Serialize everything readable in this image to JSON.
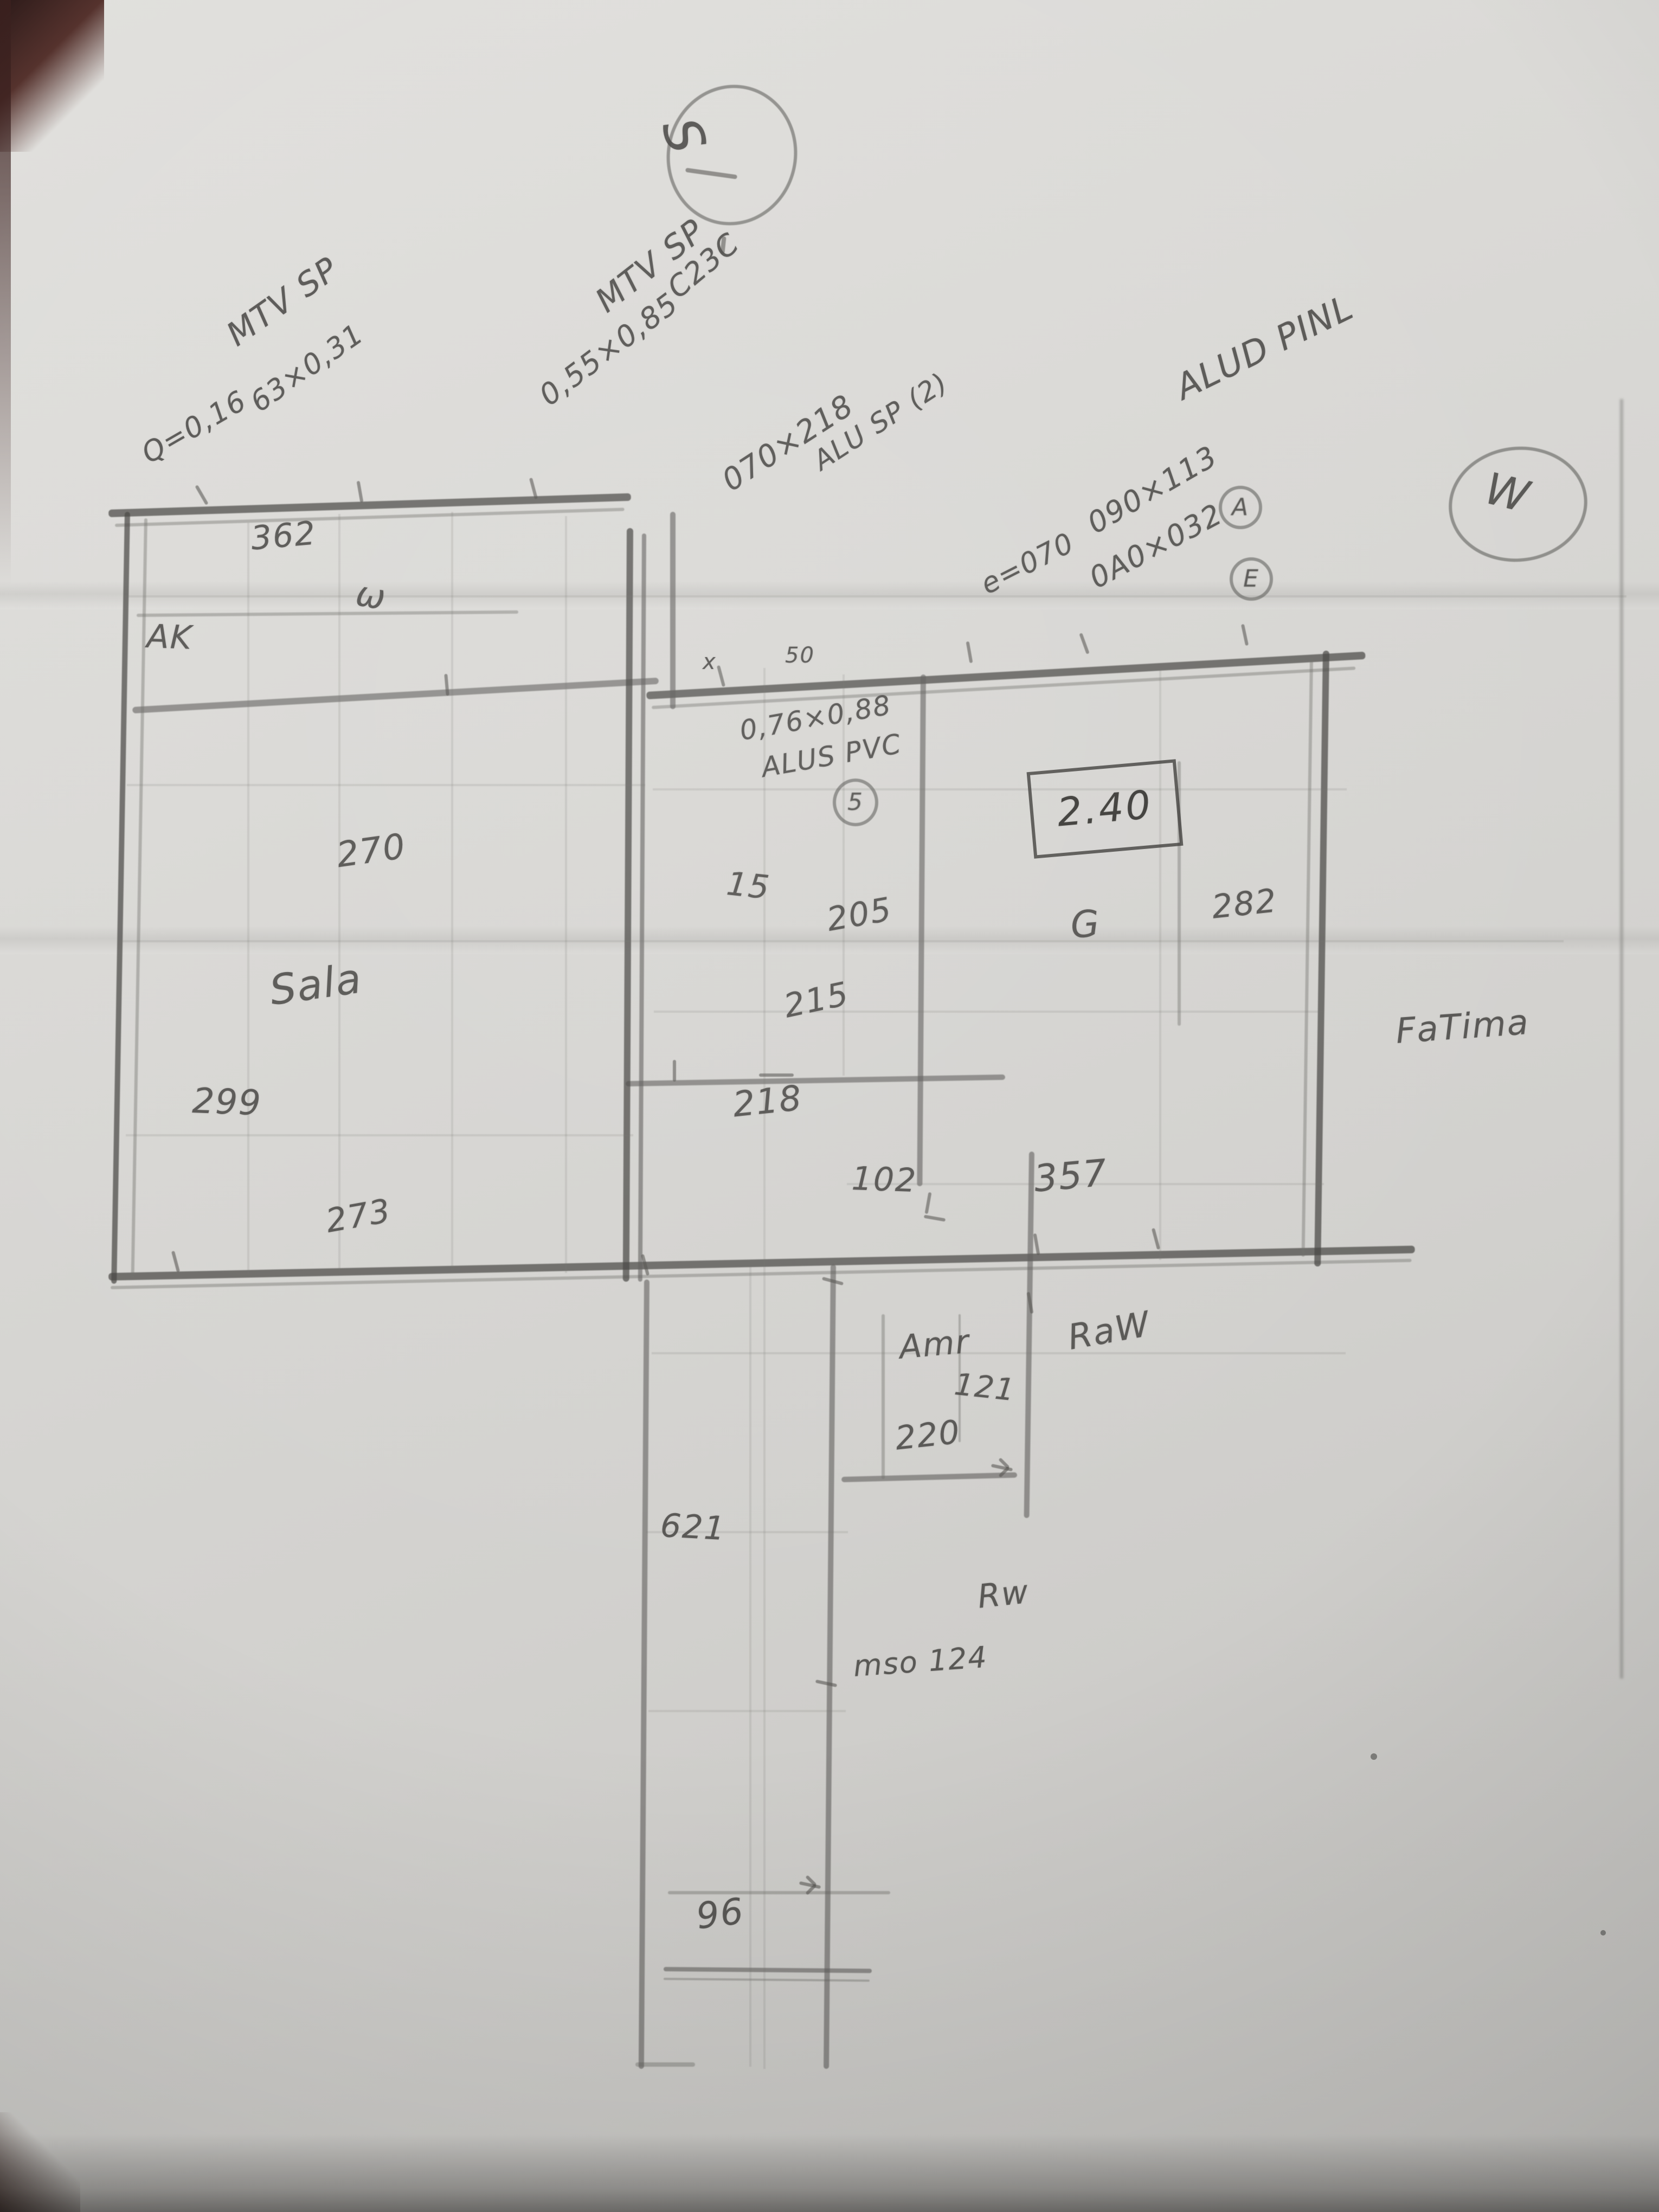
{
  "photo": {
    "paper_color": "#d8d7d4",
    "pencil_color": "#6f6e6b",
    "description_colors": {
      "photo_corner_shadow": "#54312c",
      "edge_shadow": "#8b8a87"
    }
  },
  "compass": {
    "south": "S",
    "west": "W"
  },
  "labels": {
    "win1_line1": "MTV SP",
    "win1_line2": "Q=0,16",
    "win1_line3": "63×0,31",
    "dim_362": "362",
    "win2_line1": "MTV SP",
    "win2_line2": "0,55×0,85",
    "win2_line3": "C23C",
    "door1_line1": "070×218",
    "door1_line2": "ALU SP (2)",
    "e070": "e=070",
    "alu_right": "ALUD PINL",
    "win3_line1": "090×113",
    "win3_circle": "A",
    "win4_line1": "0A0×032",
    "win4_circle": "E",
    "pvc_line1": "0,76×0,88",
    "pvc_line2": "ALUS PVC",
    "pvc_circle": "5",
    "height_240": "2.40",
    "dim_282": "282",
    "g_mark": "G",
    "fatima": "FaTima",
    "dim_15": "15",
    "dim_205": "205",
    "dim_215": "215",
    "dim_218": "218",
    "dim_270": "270",
    "room_sala": "Sala",
    "dim_299": "299",
    "dim_273": "273",
    "dim_102": "102",
    "dim_357": "357",
    "room_amr": "Amr",
    "dim_121": "121",
    "dim_220": "220",
    "name_raw": "RaW",
    "dim_621": "621",
    "rw": "Rw",
    "mso124": "mso 124",
    "dim_96": "96",
    "ak": "AK",
    "w_glyph": "ω",
    "tick_x": "x",
    "tick_50": "50"
  }
}
